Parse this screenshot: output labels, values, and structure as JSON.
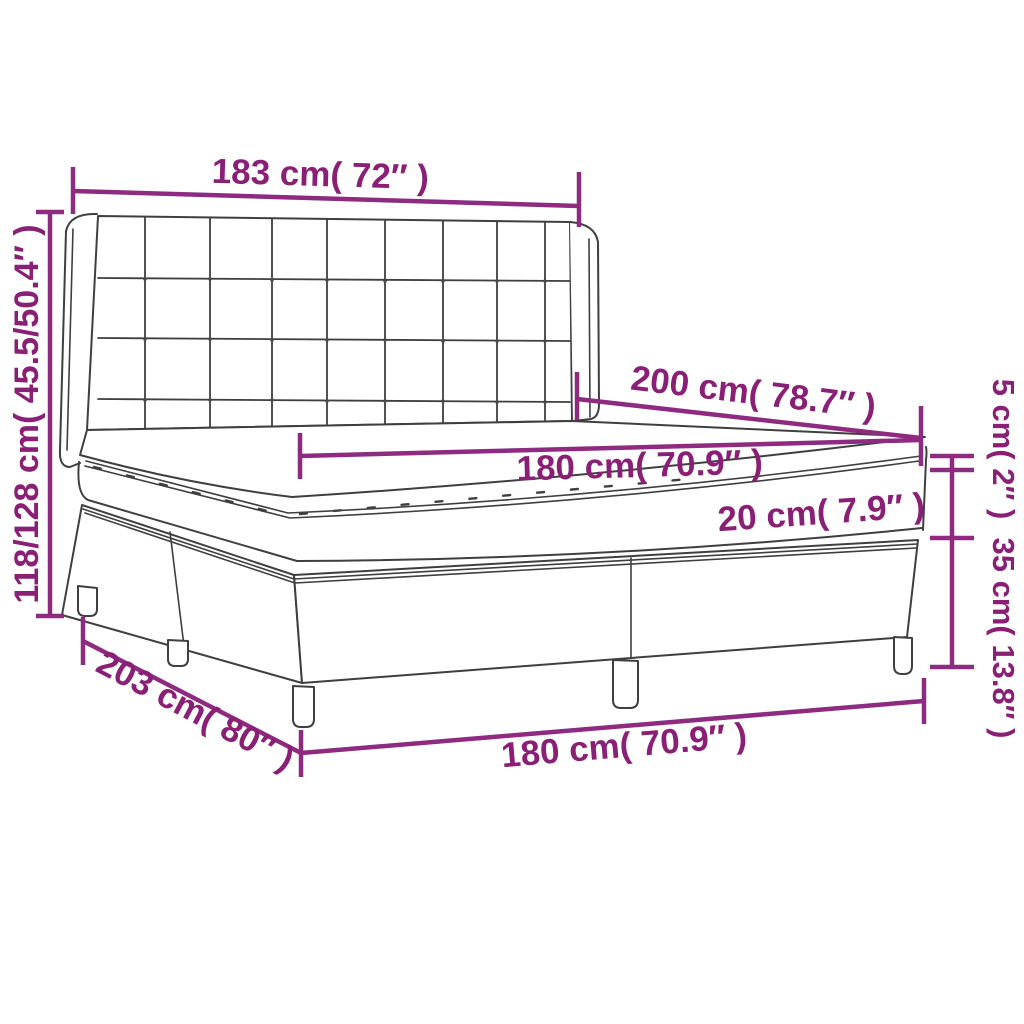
{
  "colors": {
    "background": "#ffffff",
    "outline": "#3f3f3f",
    "dimension_line": "#8e2b80",
    "dimension_text": "#8a2076"
  },
  "diagram": {
    "labels": {
      "headboard_width": "183 cm( 72″ )",
      "bed_height_range": "118/128 cm( 45.5/50.4″ )",
      "bed_length": "200 cm( 78.7″ )",
      "mattress_width": "180 cm( 70.9″ )",
      "mattress_height": "20 cm( 7.9″ )",
      "topper_height": "5 cm( 2″ )",
      "base_height": "35 cm( 13.8″ )",
      "floor_length": "203 cm( 80″ )",
      "floor_width": "180 cm( 70.9″ )"
    }
  }
}
